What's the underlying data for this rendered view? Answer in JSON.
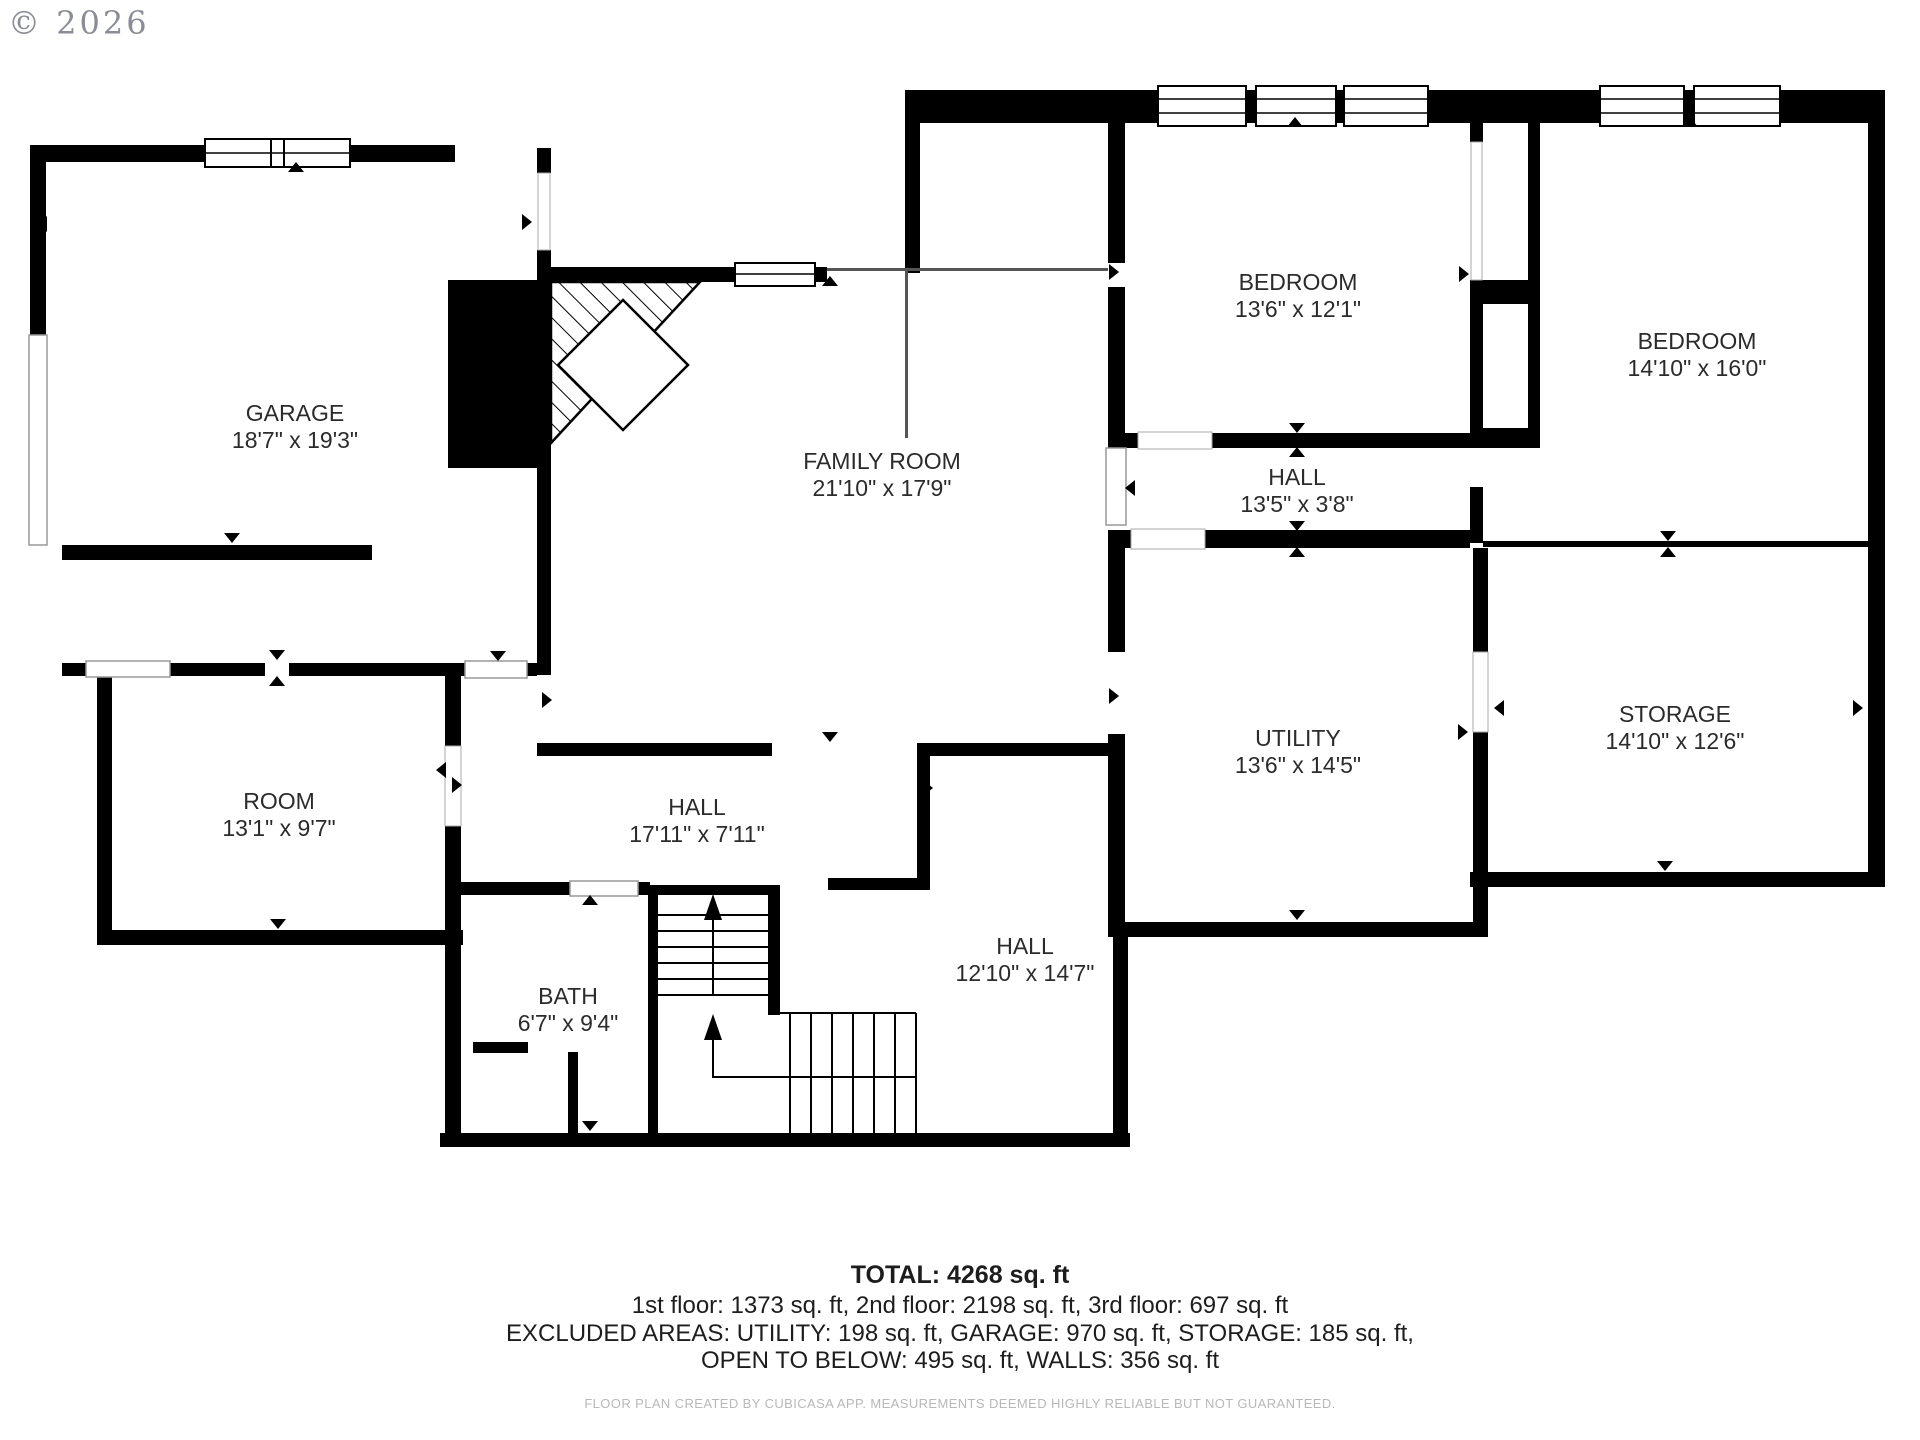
{
  "copyright": "© 2026",
  "rooms": {
    "garage": {
      "name": "GARAGE",
      "dims": "18'7\" x 19'3\""
    },
    "family_room": {
      "name": "FAMILY ROOM",
      "dims": "21'10\" x 17'9\""
    },
    "bedroom1": {
      "name": "BEDROOM",
      "dims": "13'6\" x 12'1\""
    },
    "bedroom2": {
      "name": "BEDROOM",
      "dims": "14'10\" x 16'0\""
    },
    "hall_upper": {
      "name": "HALL",
      "dims": "13'5\" x 3'8\""
    },
    "utility": {
      "name": "UTILITY",
      "dims": "13'6\" x 14'5\""
    },
    "storage": {
      "name": "STORAGE",
      "dims": "14'10\" x 12'6\""
    },
    "room": {
      "name": "ROOM",
      "dims": "13'1\" x 9'7\""
    },
    "hall_main": {
      "name": "HALL",
      "dims": "17'11\" x 7'11\""
    },
    "bath": {
      "name": "BATH",
      "dims": "6'7\" x 9'4\""
    },
    "hall_lower": {
      "name": "HALL",
      "dims": "12'10\" x 14'7\""
    }
  },
  "summary": {
    "total": "TOTAL: 4268 sq. ft",
    "floors": "1st floor: 1373 sq. ft, 2nd floor: 2198 sq. ft, 3rd floor: 697 sq. ft",
    "excluded": "EXCLUDED AREAS: UTILITY: 198 sq. ft, GARAGE: 970 sq. ft, STORAGE: 185 sq. ft,",
    "excluded2": "OPEN TO BELOW: 495 sq. ft, WALLS: 356 sq. ft"
  },
  "footer": "FLOOR PLAN CREATED BY CUBICASA APP. MEASUREMENTS DEEMED HIGHLY RELIABLE BUT NOT GUARANTEED."
}
